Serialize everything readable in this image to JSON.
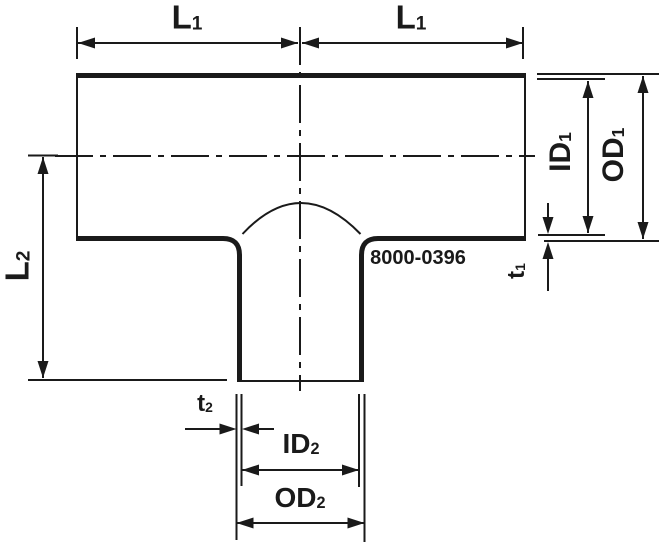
{
  "drawing": {
    "background": "#ffffff",
    "line_color": "#1a1a1a",
    "part_number": "8000-0396",
    "labels": {
      "l1_left": {
        "main": "L",
        "sub": "1"
      },
      "l1_right": {
        "main": "L",
        "sub": "1"
      },
      "l2": {
        "main": "L",
        "sub": "2"
      },
      "id1": {
        "main": "ID",
        "sub": "1"
      },
      "od1": {
        "main": "OD",
        "sub": "1"
      },
      "t1": {
        "main": "t",
        "sub": "1"
      },
      "t2": {
        "main": "t",
        "sub": "2"
      },
      "id2": {
        "main": "ID",
        "sub": "2"
      },
      "od2": {
        "main": "OD",
        "sub": "2"
      }
    }
  }
}
